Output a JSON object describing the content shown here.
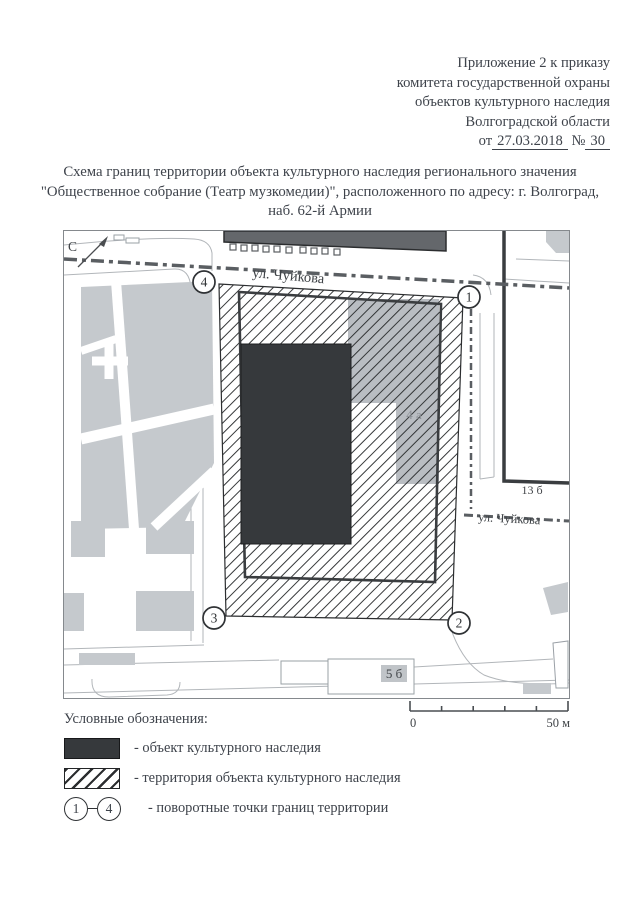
{
  "document": {
    "annex_lines": [
      "Приложение 2 к приказу",
      "комитета государственной охраны",
      "объектов культурного наследия",
      "Волгоградской области"
    ],
    "order_prefix": "от",
    "order_date": "27.03.2018",
    "order_no_sign": "№",
    "order_number": "30",
    "title": "Схема границ территории объекта культурного наследия регионального значения \"Общественное собрание (Театр музкомедии)\", расположенного по адресу: г. Волгоград, наб. 62-й Армии"
  },
  "map": {
    "north_label": "С",
    "streets": {
      "top": "ул. Чуйкова",
      "right": "ул. Чуйкова"
    },
    "parcels": {
      "adjacent": "4 а",
      "block_13b": "13 б",
      "block_5b": "5 б"
    },
    "turn_points": [
      "1",
      "2",
      "3",
      "4"
    ]
  },
  "scale_bar": {
    "zero": "0",
    "max": "50 м"
  },
  "legend": {
    "title": "Условные обозначения:",
    "object_label": "- объект культурного наследия",
    "territory_label": "- территория объекта культурного наследия",
    "points_label": "- поворотные точки границ территории",
    "point_from": "1",
    "point_to": "4"
  },
  "colors": {
    "ink": "#3e434b",
    "heritage_object_fill": "#36393c",
    "hatch_line": "#2c2e30",
    "city_block_fill": "#c5c9cd",
    "adjacent_building_fill": "#b9bdc2"
  }
}
